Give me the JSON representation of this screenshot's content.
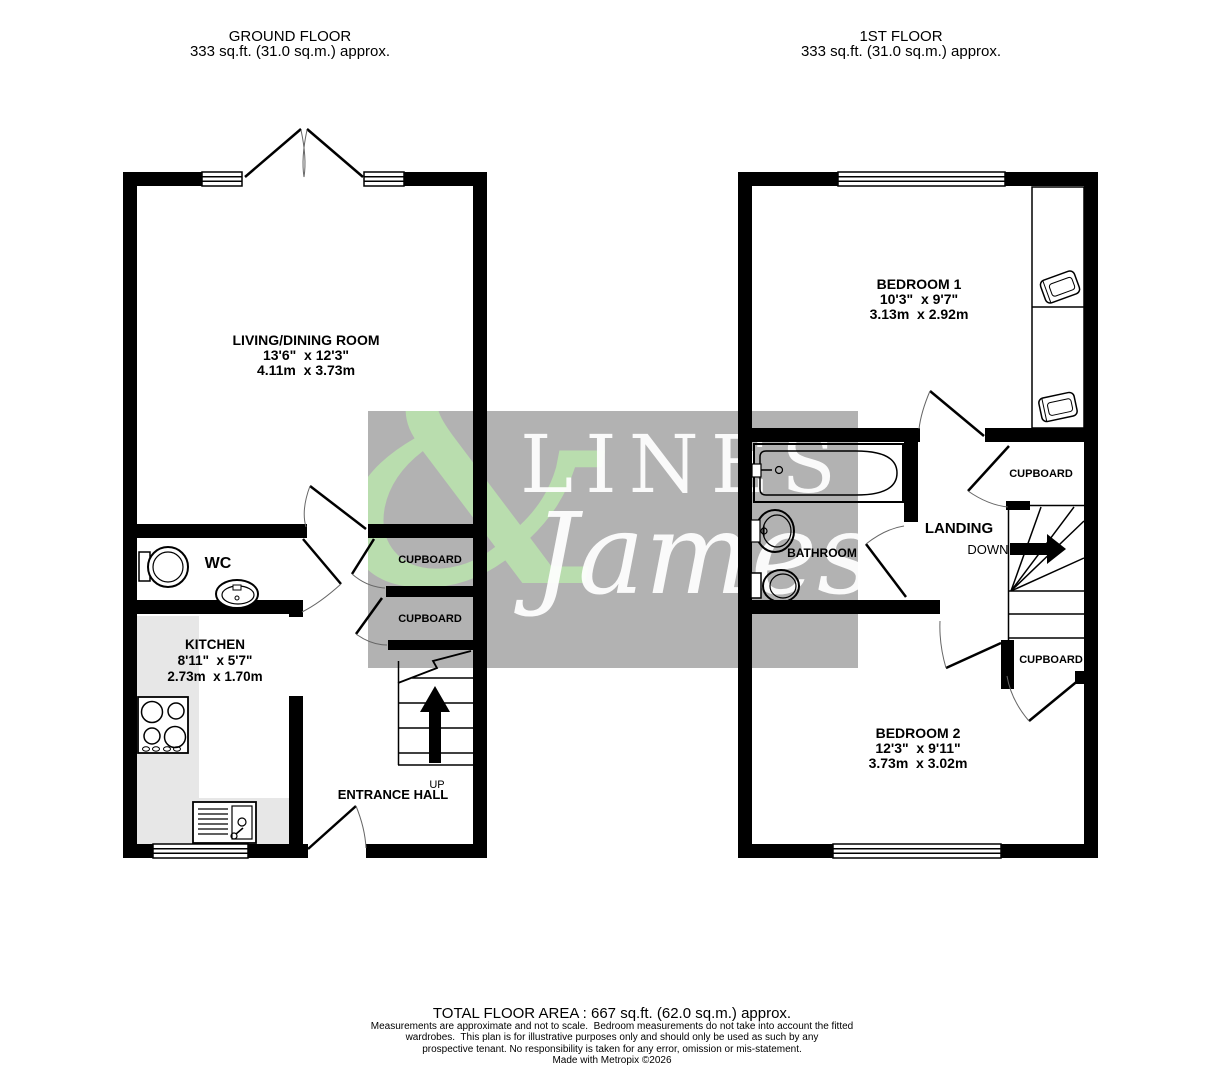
{
  "ground_floor": {
    "title": "GROUND FLOOR",
    "area": "333 sq.ft. (31.0 sq.m.) approx.",
    "rooms": {
      "living": {
        "name": "LIVING/DINING ROOM",
        "dims_imperial": "13'6\"  x 12'3\"",
        "dims_metric": "4.11m  x 3.73m"
      },
      "wc": {
        "name": "WC"
      },
      "kitchen": {
        "name": "KITCHEN",
        "dims_imperial": "8'11\"  x 5'7\"",
        "dims_metric": "2.73m  x 1.70m"
      },
      "cupboard1": {
        "name": "CUPBOARD"
      },
      "cupboard2": {
        "name": "CUPBOARD"
      },
      "entrance_hall": {
        "name": "ENTRANCE HALL"
      },
      "stairs": {
        "direction_label": "UP"
      }
    }
  },
  "first_floor": {
    "title": "1ST FLOOR",
    "area": "333 sq.ft. (31.0 sq.m.) approx.",
    "rooms": {
      "bedroom1": {
        "name": "BEDROOM 1",
        "dims_imperial": "10'3\"  x 9'7\"",
        "dims_metric": "3.13m  x 2.92m"
      },
      "bathroom": {
        "name": "BATHROOM"
      },
      "landing": {
        "name": "LANDING"
      },
      "stairs": {
        "direction_label": "DOWN"
      },
      "cupboard_top": {
        "name": "CUPBOARD"
      },
      "cupboard_bottom": {
        "name": "CUPBOARD"
      },
      "bedroom2": {
        "name": "BEDROOM 2",
        "dims_imperial": "12'3\"  x 9'11\"",
        "dims_metric": "3.73m  x 3.02m"
      }
    }
  },
  "watermark": {
    "ampersand": "&",
    "name_top": "LINES",
    "name_bottom": "James",
    "box_color": "#b2b2b2",
    "ampersand_color": "#b9ddae"
  },
  "footer": {
    "total_area": "TOTAL FLOOR AREA : 667 sq.ft. (62.0 sq.m.) approx.",
    "disclaimer_line1": "Measurements are approximate and not to scale.  Bedroom measurements do not take into account the fitted",
    "disclaimer_line2": "wardrobes.  This plan is for illustrative purposes only and should only be used as such by any",
    "disclaimer_line3": "prospective tenant. No responsibility is taken for any error, omission or mis-statement.",
    "disclaimer_line4": "Made with Metropix ©2026"
  },
  "colors": {
    "wall": "#000000",
    "counter": "#e7e7e7"
  }
}
